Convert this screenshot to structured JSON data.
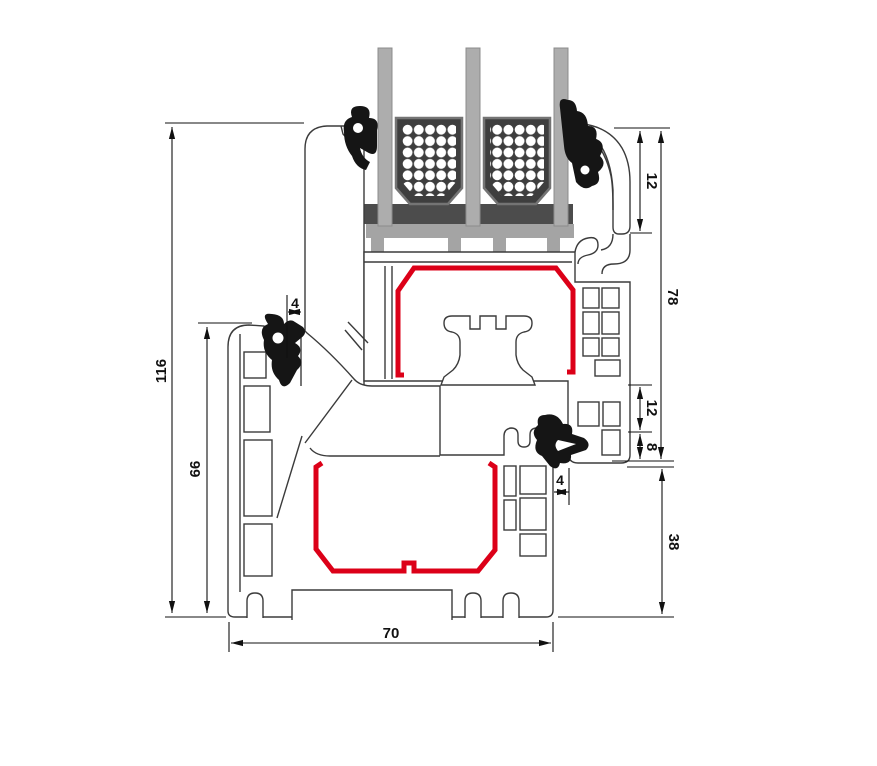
{
  "diagram": {
    "subject": "PVC window frame and sash cross-section with triple glazing",
    "type": "technical-cross-section",
    "units": "mm",
    "colors": {
      "background": "#ffffff",
      "profile_outline": "#3b3b3b",
      "steel_reinforcement_red": "#dc0018",
      "gasket_black": "#151515",
      "glass_gray": "#adadad",
      "spacer_dark": "#3e3e3e",
      "setting_block_dark": "#4c4c4c",
      "glazing_bridge_gray": "#a4a4a4",
      "dimension_ink": "#111111"
    },
    "glazing": {
      "pane_count": 3,
      "spacer_count": 2,
      "desiccant_dots": "white dot grid"
    },
    "dimension_labels": {
      "total_height": "116",
      "frame_height": "66",
      "outer_gasket_gap": "4",
      "profile_depth": "70",
      "bead_height": "12",
      "sash_height": "78",
      "rebate_upper": "12",
      "rebate_lower": "8",
      "inner_gasket_gap": "4",
      "lower_frame_height": "38"
    }
  }
}
